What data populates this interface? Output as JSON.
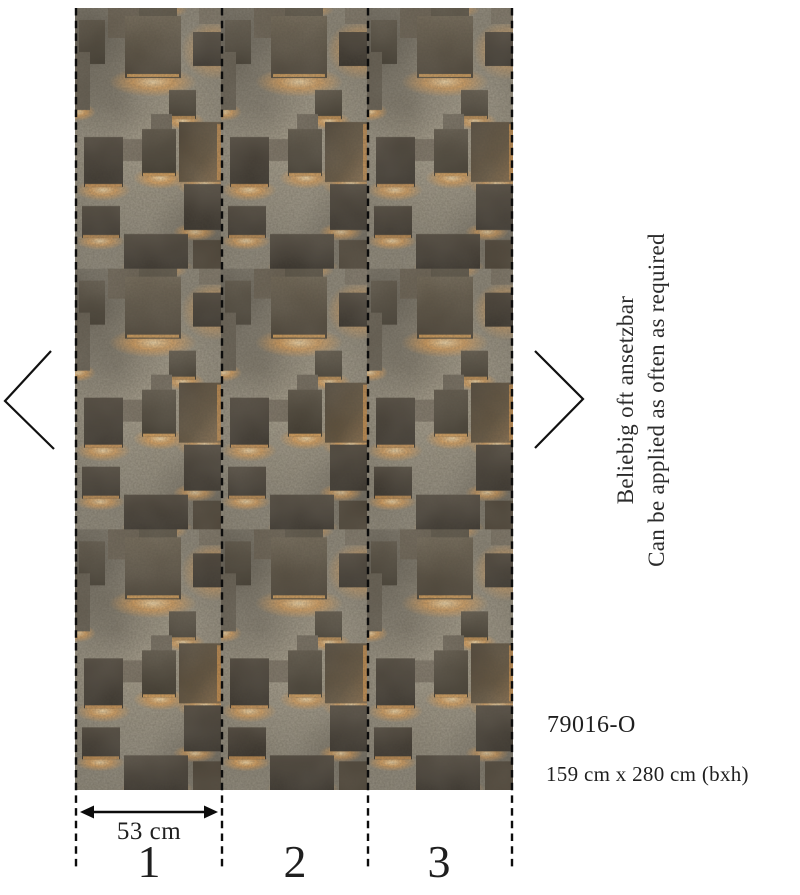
{
  "product": {
    "code": "79016-O",
    "size": "159 cm x 280 cm (bxh)",
    "note_de": "Beliebig oft ansetzbar",
    "note_en": "Can be applied as often as required"
  },
  "measurement": {
    "panel_width": "53 cm"
  },
  "panels": [
    {
      "number": "1"
    },
    {
      "number": "2"
    },
    {
      "number": "3"
    }
  ],
  "nav": {
    "prev_icon": "chevron-left",
    "next_icon": "chevron-right"
  },
  "colors": {
    "text": "#1f1f1f",
    "guide_line": "#0c0c0c",
    "concrete": "#8b8577",
    "plate_dark": "#423a2f",
    "glow": "#f2a54e"
  }
}
